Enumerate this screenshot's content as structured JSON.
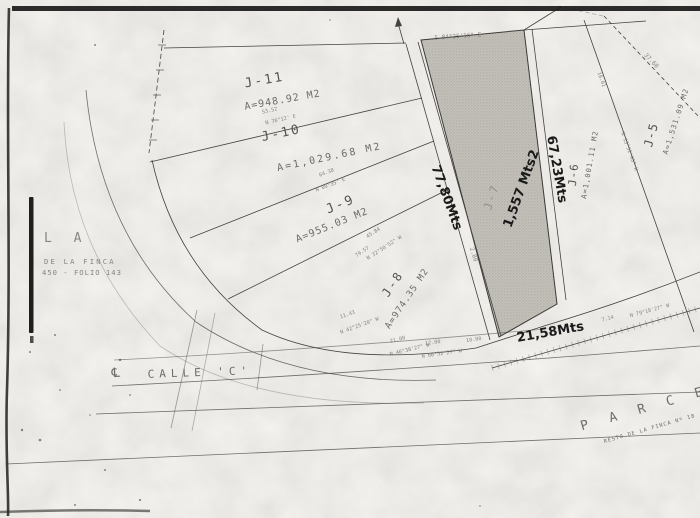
{
  "palette": {
    "paper": "#f4f2ee",
    "ink": "#45433e",
    "faded_ink": "#6e6c68",
    "handwriting": "#1a1a1a",
    "parcel_shading": "#c0bdb7",
    "scan_edge": "#161616"
  },
  "parcels": [
    {
      "id": "J-5",
      "area": "A=1,531.09 M2"
    },
    {
      "id": "J-6",
      "area": "A=1,001.11 M2"
    },
    {
      "id": "J-7"
    },
    {
      "id": "J-8",
      "area": "A=974.35 M2"
    },
    {
      "id": "J-9",
      "area": "A=955.03 M2"
    },
    {
      "id": "J-10",
      "area": "A=1,029.68 M2"
    },
    {
      "id": "J-11",
      "area": "A=948.92 M2"
    }
  ],
  "measurements": {
    "west_side": "77,80Mts",
    "east_side": "67,23Mts",
    "south_side": "21,58Mts",
    "parcel_area": "1,557 Mts2"
  },
  "street": {
    "centerline_symbol": "℄",
    "name": "CALLE 'C'"
  },
  "left_margin": {
    "line1": "L A",
    "line2": "DE LA FINCA",
    "line3": "450 - FOLIO 143"
  },
  "adjacent_parcel": {
    "label": "P A R C E",
    "note": "RESTO DE LA FINCA Nº 18"
  },
  "survey_labels": {
    "top_edge_bearing": "S 84°25'16\" E",
    "j11_j10_length": "53.52",
    "j11_j10_bearing": "N 76°12' E",
    "j10_j9_length": "64.38",
    "j10_j9_bearing": "N 09°35' E",
    "j9_j8_length": "45.84",
    "j9_j8_bearing": "N 32°50'52\" W",
    "j9_j8_length2": "79.57",
    "lane_width": "2.80",
    "ne_dashed_length": "37.60",
    "j6_j5_length": "18.01",
    "j6_j5_bearing": "N 13°51'45\" W",
    "chord1_length": "11.43",
    "chord1_bearing": "N 42°25'20\" W",
    "chord2_length": "21.00",
    "chord2_bearing": "N 46°38'27\" W",
    "chord3_bearing": "N 66°52'27\" W",
    "station1": "12.00",
    "station2": "10.00",
    "se_road_length": "7.14",
    "se_road_bearing": "N 79°18'27\" W"
  }
}
